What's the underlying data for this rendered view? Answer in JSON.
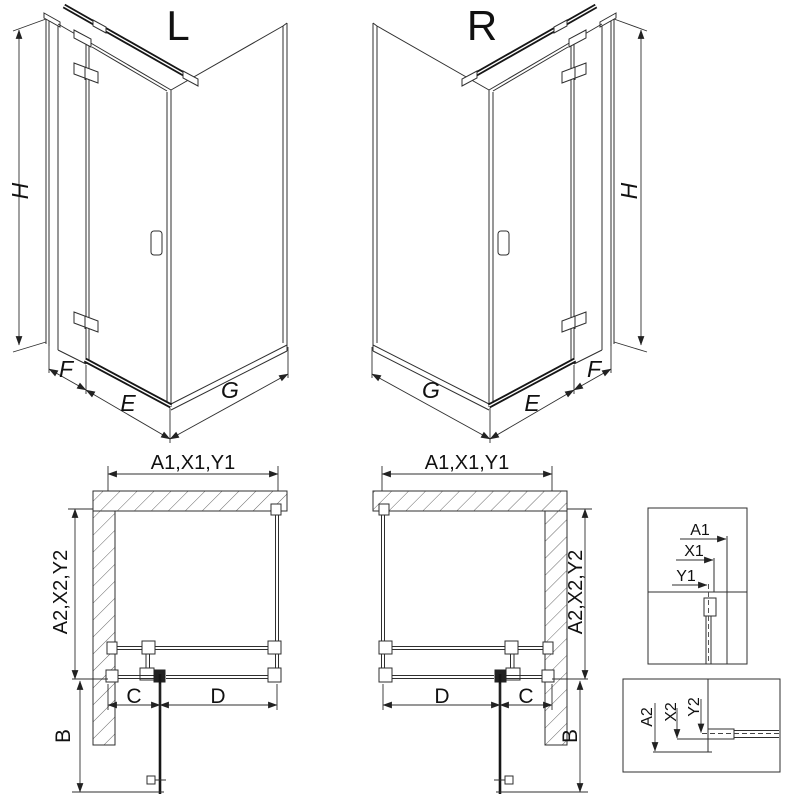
{
  "title_left": "L",
  "title_right": "R",
  "iso_left": {
    "h": "H",
    "f": "F",
    "e": "E",
    "g": "G"
  },
  "iso_right": {
    "h": "H",
    "f": "F",
    "e": "E",
    "g": "G"
  },
  "plan_left": {
    "top": "A1,X1,Y1",
    "side": "A2,X2,Y2",
    "c": "C",
    "d": "D",
    "b": "B"
  },
  "plan_right": {
    "top": "A1,X1,Y1",
    "side": "A2,X2,Y2",
    "c": "C",
    "d": "D",
    "b": "B"
  },
  "detail_top": {
    "a1": "A1",
    "x1": "X1",
    "y1": "Y1"
  },
  "detail_bottom": {
    "a2": "A2",
    "x2": "X2",
    "y2": "Y2"
  },
  "colors": {
    "line": "#2f2f2f",
    "dark": "#161616",
    "hatch": "#555555",
    "background": "#ffffff"
  }
}
